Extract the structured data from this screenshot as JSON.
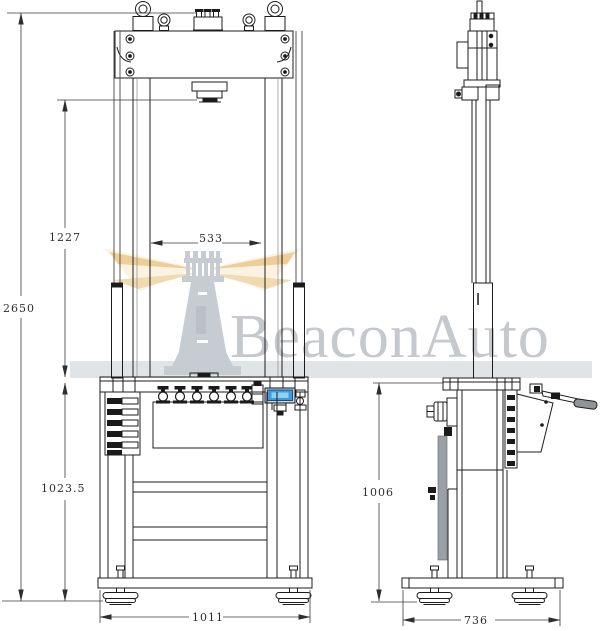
{
  "watermark": {
    "brand": "BeaconAuto",
    "logo": "lighthouse-icon",
    "colors": {
      "mark": "#c6ccd2",
      "text": "#c5c9cd",
      "beam_core": "#ecc98f",
      "beam_halo": "#f7ecd2",
      "band": "#dcdfe2"
    }
  },
  "drawing": {
    "type": "engineering-drawing",
    "views": [
      "front-view",
      "side-view"
    ],
    "line_color": "#1c1c1c",
    "display_screen_color": "#3d9ae0",
    "dimensions": {
      "total_height": "2650",
      "daylight_opening": "1227",
      "column_clear_width": "533",
      "table_height_front": "1023.5",
      "base_width_front": "1011",
      "table_height_side": "1006",
      "base_depth_side": "736"
    }
  }
}
